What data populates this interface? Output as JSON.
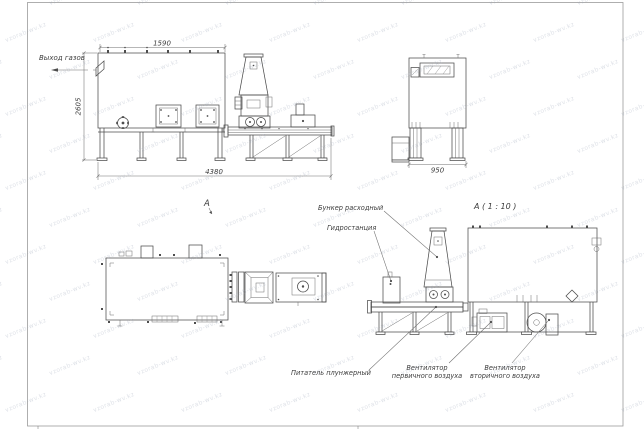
{
  "drawing": {
    "labels": {
      "gas_outlet": "Выход газов",
      "hopper": "Бункер расходный",
      "hydrostation": "Гидростанция",
      "feeder": "Питатель плунжерный",
      "primary_fan_line1": "Вентилятор",
      "primary_fan_line2": "первичного воздуха",
      "secondary_fan_line1": "Вентилятор",
      "secondary_fan_line2": "вторичного воздуха",
      "view_marker": "A",
      "view_detail": "A ( 1 : 10 )"
    },
    "dimensions": {
      "front_top_width": "1590",
      "front_height": "2605",
      "front_overall_length": "4380",
      "end_view_width": "950"
    }
  },
  "watermark": {
    "text": "vzorab-wv.kz"
  },
  "colors": {
    "background": "#ffffff",
    "line": "#4d4d4d",
    "dim_line": "#707070",
    "text": "#3c3c3c",
    "watermark": "#99a3b6",
    "frame": "#9b9b9b"
  }
}
